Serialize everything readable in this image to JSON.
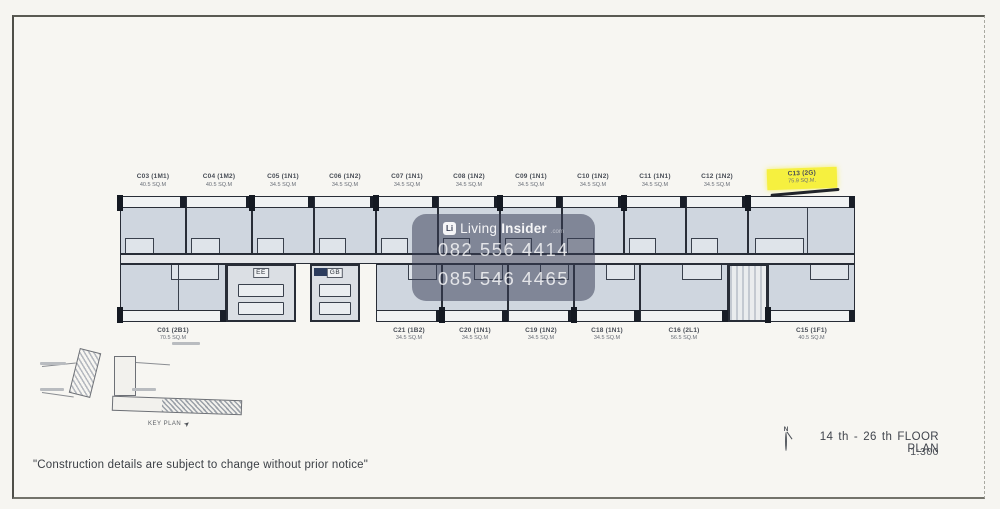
{
  "colors": {
    "highlight": "#f4ee40",
    "plan_line": "#2a2f38",
    "room_fill": "#cdd4dd",
    "watermark_bg": "rgba(56,62,84,0.52)"
  },
  "watermark": {
    "brand_icon": "Li",
    "brand_light": "Living",
    "brand_bold": "Insider",
    "brand_suffix": ".com",
    "phone1": "082 556 4414",
    "phone2": "085 546 4465"
  },
  "plan": {
    "top_units": [
      {
        "code": "C03 (1M1)",
        "area": "40.5 SQ.M",
        "w": 66
      },
      {
        "code": "C04 (1M2)",
        "area": "40.5 SQ.M",
        "w": 66
      },
      {
        "code": "C05 (1N1)",
        "area": "34.5 SQ.M",
        "w": 62
      },
      {
        "code": "C06 (1N2)",
        "area": "34.5 SQ.M",
        "w": 62
      },
      {
        "code": "C07 (1N1)",
        "area": "34.5 SQ.M",
        "w": 62
      },
      {
        "code": "C08 (1N2)",
        "area": "34.5 SQ.M",
        "w": 62
      },
      {
        "code": "C09 (1N1)",
        "area": "34.5 SQ.M",
        "w": 62
      },
      {
        "code": "C10 (1N2)",
        "area": "34.5 SQ.M",
        "w": 62
      },
      {
        "code": "C11 (1N1)",
        "area": "34.5 SQ.M",
        "w": 62
      },
      {
        "code": "C12 (1N2)",
        "area": "34.5 SQ.M",
        "w": 62
      },
      {
        "code": "C13 (2G)",
        "area": "75.9 SQ.M.",
        "w": 107,
        "highlight": true
      }
    ],
    "bottom_segments": [
      {
        "type": "unit",
        "code": "C01 (2B1)",
        "area": "70.5 SQ.M",
        "w": 106
      },
      {
        "type": "core",
        "label": "EE",
        "w": 70
      },
      {
        "type": "gap",
        "w": 14
      },
      {
        "type": "core",
        "label": "GB",
        "w": 50
      },
      {
        "type": "gap",
        "w": 16
      },
      {
        "type": "unit",
        "code": "C21 (1B2)",
        "area": "34.5 SQ.M",
        "w": 66
      },
      {
        "type": "unit",
        "code": "C20 (1N1)",
        "area": "34.5 SQ.M",
        "w": 66
      },
      {
        "type": "unit",
        "code": "C19 (1N2)",
        "area": "34.5 SQ.M",
        "w": 66
      },
      {
        "type": "unit",
        "code": "C18 (1N1)",
        "area": "34.5 SQ.M",
        "w": 66
      },
      {
        "type": "unit",
        "code": "C16 (2L1)",
        "area": "56.5 SQ.M",
        "w": 88
      },
      {
        "type": "core",
        "label": "",
        "w": 40
      },
      {
        "type": "unit",
        "code": "C15 (1F1)",
        "area": "40.5 SQ.M",
        "w": 87
      }
    ]
  },
  "keyplan": {
    "caption": "KEY PLAN"
  },
  "titleblock": {
    "north_label": "N",
    "title": "14 th - 26 th FLOOR PLAN",
    "scale": "1:300"
  },
  "footer": {
    "disclaimer": "\"Construction details are subject to change without prior notice\""
  }
}
